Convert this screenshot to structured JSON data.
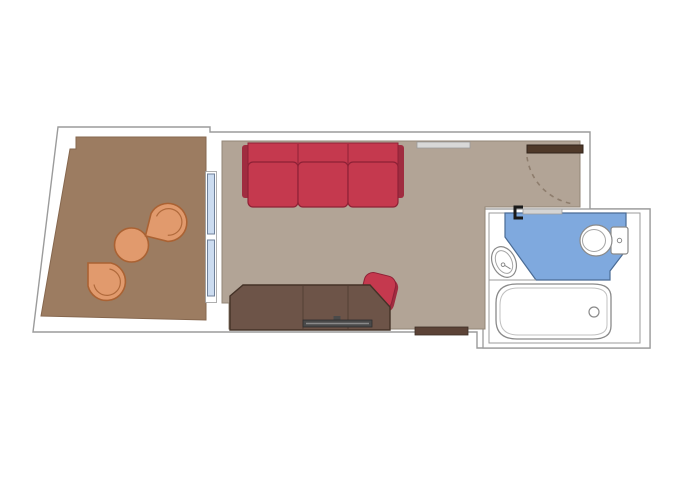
{
  "title": "Stateroom floor plan with balcony and bathroom",
  "plan": {
    "rooms": [
      {
        "name": "balcony",
        "floor": "wood-brown",
        "furniture": [
          "lounge-chair",
          "lounge-chair",
          "round-table"
        ]
      },
      {
        "name": "living-area",
        "floor": "taupe-carpet",
        "furniture": [
          "sofa-3-seat",
          "desk-dresser",
          "tv",
          "desk-chair",
          "wall-shelf",
          "sideboard",
          "entry-door"
        ]
      },
      {
        "name": "bathroom",
        "floor": "blue-tile",
        "furniture": [
          "sink",
          "toilet",
          "bathtub",
          "sliding-door"
        ]
      }
    ]
  },
  "palette": {
    "background": "#ffffff",
    "wall_fill": "#ffffff",
    "wall_stroke": "#9b9b9b",
    "balcony_floor": "#9c7c61",
    "balcony_floor_stroke": "#86674e",
    "room_floor": "#b2a496",
    "room_floor_stroke": "#938677",
    "glass_blue": "#ccdcf0",
    "glass_stroke": "#70819a",
    "chair_tan": "#e19a6d",
    "chair_stroke": "#aa6233",
    "sofa_red": "#c5394e",
    "sofa_dark": "#8e2136",
    "sofa_shadow": "#a02c40",
    "desk_wood": "#6d5448",
    "desk_stroke": "#443227",
    "desk_seam": "#543f33",
    "tv_gray": "#4a4a4a",
    "tv_stroke": "#2e2e2e",
    "door_wood": "#4f3929",
    "door_stroke": "#32241b",
    "arc_dash": "#8e7d6d",
    "strip_brown": "#5c4337",
    "bath_blue": "#7fa9de",
    "bath_blue_stroke": "#4a6b94",
    "fixture_fill": "#ffffff",
    "fixture_stroke": "#8a8a8a",
    "fixture_inner": "#b5b5b5",
    "shelf_gray": "#d8d8d8",
    "bracket_black": "#1a1a1a",
    "slider_gray": "#d4d4d4"
  }
}
